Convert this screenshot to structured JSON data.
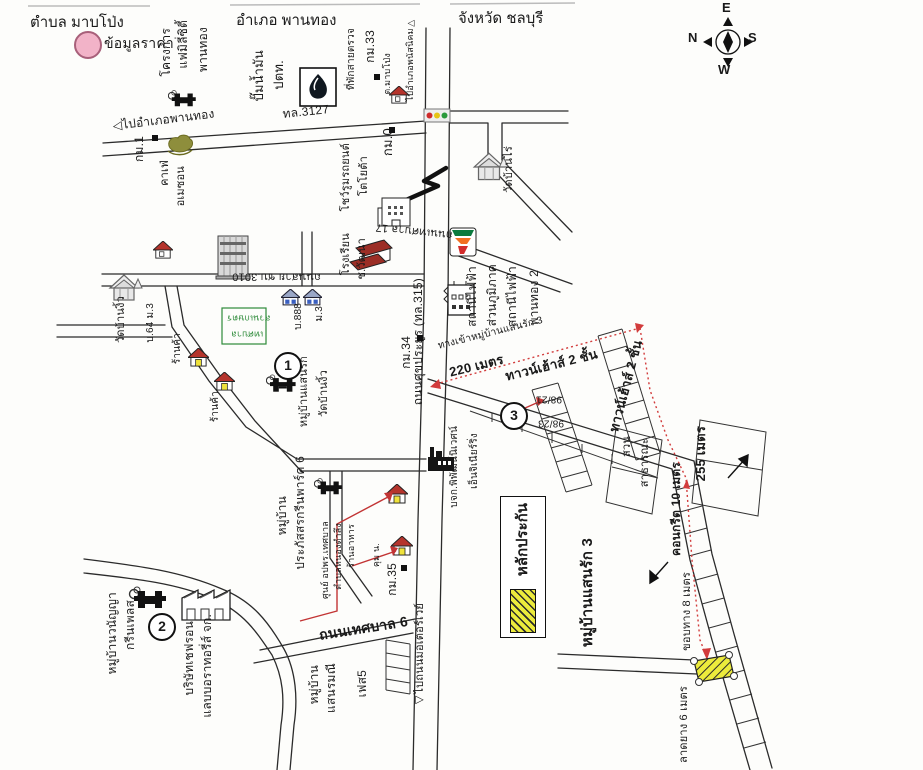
{
  "header": {
    "tambon": "ตำบล มาบโป่ง",
    "amphoe": "อำเภอ พานทอง",
    "province": "จังหวัด ชลบุรี"
  },
  "legend": {
    "price_label": "ข้อมูลราคา",
    "guarantee_label": "หลักประกัน",
    "price_swatch_color": "#f2b3c8",
    "guarantee_swatch_color": "#eceb3c"
  },
  "compass": {
    "n": "N",
    "e": "E",
    "s": "S",
    "w": "W"
  },
  "markers": [
    {
      "name": "marker-1",
      "t": "1",
      "x": 274,
      "y": 352
    },
    {
      "name": "marker-2",
      "t": "2",
      "x": 148,
      "y": 613
    },
    {
      "name": "marker-3",
      "t": "3",
      "x": 500,
      "y": 402
    }
  ],
  "km_squares": [
    {
      "x": 374,
      "y": 74
    },
    {
      "x": 152,
      "y": 135
    },
    {
      "x": 389,
      "y": 127
    },
    {
      "x": 417,
      "y": 335
    },
    {
      "x": 401,
      "y": 565
    }
  ],
  "map_labels": [
    {
      "name": "label-project-family-1",
      "t": "โครงการ",
      "x": 160,
      "y": 28,
      "m": "v",
      "s": 12
    },
    {
      "name": "label-project-family-2",
      "t": "แฟมิลี่ซิตี้",
      "x": 177,
      "y": 20,
      "m": "v",
      "s": 12
    },
    {
      "name": "label-project-family-3",
      "t": "พานทอง",
      "x": 197,
      "y": 27,
      "m": "v",
      "s": 12
    },
    {
      "name": "label-ptt-1",
      "t": "ปั๊มน้ำมัน",
      "x": 252,
      "y": 50,
      "m": "v",
      "s": 13
    },
    {
      "name": "label-ptt-2",
      "t": "ปตท.",
      "x": 272,
      "y": 60,
      "m": "v",
      "s": 13
    },
    {
      "name": "label-police-point",
      "t": "ที่พักสายตรวจ",
      "x": 347,
      "y": 28,
      "m": "v",
      "s": 10
    },
    {
      "name": "label-km33",
      "t": "กม.33",
      "x": 364,
      "y": 30,
      "m": "v",
      "s": 12
    },
    {
      "name": "label-tambon-mabpong",
      "t": "ต.มาบโป่ง",
      "x": 383,
      "y": 53,
      "m": "v",
      "s": 9
    },
    {
      "name": "label-to-phanatnikhom",
      "t": "ไปอำเภอพนัสนิคม▷",
      "x": 406,
      "y": 18,
      "m": "v",
      "s": 9
    },
    {
      "name": "label-to-phanthong",
      "t": "◁ไปอำเภอพานทอง",
      "x": 112,
      "y": 120,
      "m": "r",
      "r": -7,
      "s": 12
    },
    {
      "name": "label-road-3127",
      "t": "ทล.3127",
      "x": 282,
      "y": 108,
      "m": "r",
      "r": -6,
      "s": 12
    },
    {
      "name": "label-km1",
      "t": "กม.1",
      "x": 133,
      "y": 136,
      "m": "v",
      "s": 12
    },
    {
      "name": "label-cafe-amazon-1",
      "t": "คาเฟ่",
      "x": 160,
      "y": 160,
      "m": "v",
      "s": 11
    },
    {
      "name": "label-cafe-amazon-2",
      "t": "อเมซอน",
      "x": 176,
      "y": 166,
      "m": "v",
      "s": 11
    },
    {
      "name": "label-km0",
      "t": "กม.0",
      "x": 381,
      "y": 128,
      "m": "v",
      "s": 13
    },
    {
      "name": "label-showroom-1",
      "t": "โชว์รูมรถยนต์",
      "x": 341,
      "y": 143,
      "m": "v",
      "s": 11
    },
    {
      "name": "label-showroom-2",
      "t": "โตโยต้า",
      "x": 359,
      "y": 156,
      "m": "v",
      "s": 11
    },
    {
      "name": "label-school-chw-1",
      "t": "โรงเรียน",
      "x": 341,
      "y": 233,
      "m": "v",
      "s": 11
    },
    {
      "name": "label-school-chw-2",
      "t": "ช.วัฒนา",
      "x": 357,
      "y": 238,
      "m": "v",
      "s": 11
    },
    {
      "name": "label-wat-banrai",
      "t": "วัดบ้านไร่",
      "x": 504,
      "y": 146,
      "m": "v",
      "s": 11
    },
    {
      "name": "label-road-tessaban17",
      "t": "ถนนเทศบาล 17",
      "x": 452,
      "y": 240,
      "m": "r",
      "r": 186,
      "s": 11
    },
    {
      "name": "label-road-chb3010",
      "t": "ถนนสาย ชบ.3010",
      "x": 232,
      "y": 270,
      "m": "f",
      "s": 11
    },
    {
      "name": "label-house-888",
      "t": "บ.888",
      "x": 294,
      "y": 303,
      "m": "v",
      "s": 10
    },
    {
      "name": "label-house-m3",
      "t": "ม.3",
      "x": 315,
      "y": 306,
      "m": "v",
      "s": 10
    },
    {
      "name": "label-wat-banngio",
      "t": "วัดบ้านงิ้ว",
      "x": 116,
      "y": 296,
      "m": "v",
      "s": 11
    },
    {
      "name": "label-house-64",
      "t": "บ.64 ม.3",
      "x": 146,
      "y": 303,
      "m": "v",
      "s": 10
    },
    {
      "name": "label-shop-1",
      "t": "ร้านค้า",
      "x": 173,
      "y": 333,
      "m": "v",
      "s": 10
    },
    {
      "name": "label-shop-2",
      "t": "ร้านค้า",
      "x": 211,
      "y": 391,
      "m": "v",
      "s": 10
    },
    {
      "name": "label-green-note-1",
      "t": "สวนเกษตร",
      "x": 227,
      "y": 313,
      "m": "f",
      "s": 9,
      "c": "#2e8b3a"
    },
    {
      "name": "label-green-note-2",
      "t": "เทศบาล",
      "x": 231,
      "y": 329,
      "m": "f",
      "s": 9,
      "c": "#2e8b3a"
    },
    {
      "name": "label-km34",
      "t": "กม.34",
      "x": 400,
      "y": 336,
      "m": "v",
      "s": 12
    },
    {
      "name": "label-road-sukprayoon",
      "t": "ถนนศุขประยูร (ทล.315)",
      "x": 412,
      "y": 278,
      "m": "v",
      "s": 12
    },
    {
      "name": "label-pea-1",
      "t": "สถานีไฟฟ้า",
      "x": 466,
      "y": 266,
      "m": "v",
      "s": 12
    },
    {
      "name": "label-pea-2",
      "t": "ส่วนภูมิภาค",
      "x": 486,
      "y": 264,
      "m": "v",
      "s": 12
    },
    {
      "name": "label-pea-3",
      "t": "สถานีไฟฟ้า",
      "x": 506,
      "y": 266,
      "m": "v",
      "s": 12
    },
    {
      "name": "label-pea-4",
      "t": "พานทอง 2",
      "x": 528,
      "y": 270,
      "m": "v",
      "s": 12
    },
    {
      "name": "label-sanrak1",
      "t": "หมู่บ้านแสนรัก",
      "x": 299,
      "y": 356,
      "m": "v",
      "s": 11
    },
    {
      "name": "label-wat-banngio-2",
      "t": "วัดบ้านงิ้ว",
      "x": 319,
      "y": 370,
      "m": "v",
      "s": 11
    },
    {
      "name": "label-entrance-sanrak3",
      "t": "ทางเข้าหมู่บ้านแสนรัก 3",
      "x": 437,
      "y": 342,
      "m": "r",
      "r": -14,
      "s": 10
    },
    {
      "name": "label-dist-220m",
      "t": "220 เมตร",
      "x": 448,
      "y": 366,
      "m": "r",
      "r": -14,
      "s": 13,
      "b": 1
    },
    {
      "name": "label-townhouse-a",
      "t": "ทาวน์เฮ้าส์ 2 ชั้น",
      "x": 504,
      "y": 370,
      "m": "r",
      "r": -14,
      "s": 13,
      "b": 1
    },
    {
      "name": "label-townhouse-b",
      "t": "ทาวน์เฮ้าส์ 2 ชั้น",
      "x": 607,
      "y": 430,
      "m": "r",
      "r": -75,
      "s": 13,
      "b": 1
    },
    {
      "name": "label-no-9821",
      "t": "98/21",
      "x": 536,
      "y": 393,
      "m": "f",
      "s": 10
    },
    {
      "name": "label-no-9823",
      "t": "98/23",
      "x": 538,
      "y": 417,
      "m": "f",
      "s": 10
    },
    {
      "name": "label-park-1",
      "t": "สวน",
      "x": 622,
      "y": 436,
      "m": "v",
      "s": 11
    },
    {
      "name": "label-park-2",
      "t": "สาธารณะ",
      "x": 640,
      "y": 438,
      "m": "v",
      "s": 11
    },
    {
      "name": "label-concrete-10m",
      "t": "คอนกรีต 10 เมตร",
      "x": 670,
      "y": 462,
      "m": "v",
      "s": 12,
      "b": 1
    },
    {
      "name": "label-dist-255m",
      "t": "255 เมตร",
      "x": 694,
      "y": 426,
      "m": "v",
      "s": 13,
      "b": 1
    },
    {
      "name": "label-sanrak3",
      "t": "หมู่บ้านแสนรัก 3",
      "x": 580,
      "y": 538,
      "m": "v",
      "s": 15,
      "b": 1
    },
    {
      "name": "label-edge-8m",
      "t": "ขอบทาง 8 เมตร",
      "x": 682,
      "y": 572,
      "m": "v",
      "s": 11
    },
    {
      "name": "label-asphalt-6m",
      "t": "ลาดยาง 6 เมตร",
      "x": 679,
      "y": 686,
      "m": "v",
      "s": 11
    },
    {
      "name": "label-pipat-1",
      "t": "บจก.พิพัฒน์นิเวศน์",
      "x": 450,
      "y": 426,
      "m": "v",
      "s": 10
    },
    {
      "name": "label-pipat-2",
      "t": "เอ็นจิเนียร์ริ่ง",
      "x": 470,
      "y": 433,
      "m": "v",
      "s": 10
    },
    {
      "name": "label-prapatsorn-1",
      "t": "หมู่บ้าน",
      "x": 276,
      "y": 496,
      "m": "v",
      "s": 12
    },
    {
      "name": "label-prapatsorn-2",
      "t": "ประภัสสรกรีนพาร์ค 6",
      "x": 294,
      "y": 456,
      "m": "v",
      "s": 12
    },
    {
      "name": "label-oppor-1",
      "t": "ศูนย์ อปพร.เทศบาล",
      "x": 321,
      "y": 521,
      "m": "v",
      "s": 9
    },
    {
      "name": "label-oppor-2",
      "t": "ตำบลหนองตำลึง",
      "x": 334,
      "y": 523,
      "m": "v",
      "s": 9
    },
    {
      "name": "label-restaurant",
      "t": "ร้านอาหาร",
      "x": 347,
      "y": 524,
      "m": "v",
      "s": 9
    },
    {
      "name": "label-kum-n",
      "t": "คุม น.",
      "x": 372,
      "y": 543,
      "m": "v",
      "s": 9
    },
    {
      "name": "label-km35",
      "t": "กม.35",
      "x": 386,
      "y": 563,
      "m": "v",
      "s": 12
    },
    {
      "name": "label-road-tessaban6",
      "t": "ถนนเทศบาล 6",
      "x": 318,
      "y": 628,
      "m": "r",
      "r": -9,
      "s": 14,
      "b": 1
    },
    {
      "name": "label-sanramanee-1",
      "t": "หมู่บ้าน",
      "x": 308,
      "y": 665,
      "m": "v",
      "s": 12
    },
    {
      "name": "label-sanramanee-2",
      "t": "แสนรมณี",
      "x": 325,
      "y": 663,
      "m": "v",
      "s": 12
    },
    {
      "name": "label-sanramanee-3",
      "t": "เฟส5",
      "x": 356,
      "y": 670,
      "m": "v",
      "s": 12
    },
    {
      "name": "label-to-motorway",
      "t": "◁ไปถนนมอเตอร์เวย์",
      "x": 415,
      "y": 603,
      "m": "v",
      "s": 11
    },
    {
      "name": "label-chevron-1",
      "t": "บริษัทเชฟรอน",
      "x": 183,
      "y": 621,
      "m": "v",
      "s": 12
    },
    {
      "name": "label-chevron-2",
      "t": "แลบบอราทอรี่ส์ จก.",
      "x": 201,
      "y": 614,
      "m": "v",
      "s": 12
    },
    {
      "name": "label-wananya-1",
      "t": "หมู่บ้านวนัญญา",
      "x": 106,
      "y": 592,
      "m": "v",
      "s": 12
    },
    {
      "name": "label-wananya-2",
      "t": "กรีนเพลส",
      "x": 124,
      "y": 600,
      "m": "v",
      "s": 12
    }
  ]
}
